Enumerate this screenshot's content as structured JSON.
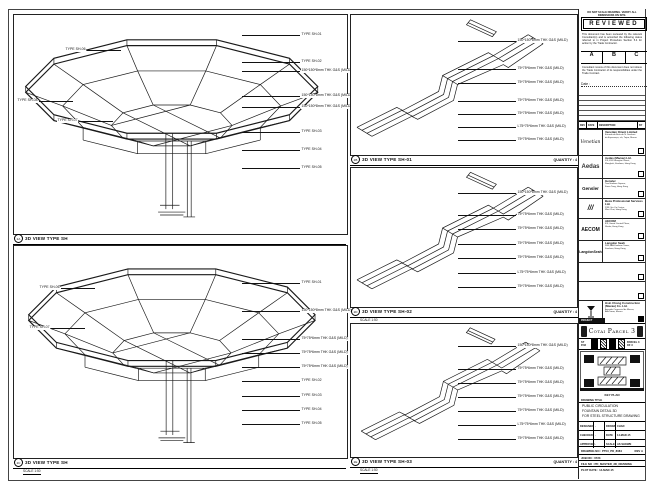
{
  "panels": {
    "left_top": {
      "ref": "2A",
      "title": "3D VIEW TYPE SH",
      "right_labels": [
        "TYPE SH-01",
        "TYPE SH-02",
        "150*150*8mm THK G&S (MILD)",
        "150*150*8mm THK G&S (MILD)",
        "150*150*8mm THK G&S (MILD)",
        "TYPE SH-03",
        "TYPE SH-04",
        "TYPE SH-05"
      ],
      "left_labels": [
        "TYPE SH-06",
        "TYPE SH-07",
        "TYPE SH-08"
      ]
    },
    "left_bottom": {
      "ref": "2C",
      "title": "3D VIEW TYPE SH",
      "scale": "SCALE 1:50",
      "right_labels": [
        "TYPE SH-01",
        "150*150*8mm THK G&S (MILD)",
        "75*75*6mm THK G&S (MILD)",
        "75*75*6mm THK G&S (MILD)",
        "75*75*6mm THK G&S (MILD)",
        "TYPE SH-02",
        "TYPE SH-03",
        "TYPE SH-04",
        "TYPE SH-05"
      ],
      "left_labels": [
        "TYPE SH-06",
        "TYPE SH-07"
      ]
    },
    "mid": [
      {
        "ref": "2B",
        "title": "3D VIEW TYPE SH-01",
        "quantity": "QUANTITY : 4",
        "labels": [
          "150*150*8mm THK G&S (MILD)",
          "75*75*6mm THK G&S (MILD)",
          "75*75*6mm THK G&S (MILD)",
          "75*75*6mm THK G&S (MILD)",
          "75*75*6mm THK G&S (MILD)",
          "L75*75*6mm THK G&S (MILD)",
          "75*75*6mm THK G&S (MILD)"
        ]
      },
      {
        "ref": "2D",
        "title": "3D VIEW TYPE SH-02",
        "quantity": "QUANTITY : 4",
        "scale": "SCALE 1:50",
        "labels": [
          "150*150*8mm THK G&S (MILD)",
          "75*75*6mm THK G&S (MILD)",
          "75*75*6mm THK G&S (MILD)",
          "75*75*6mm THK G&S (MILD)",
          "75*75*6mm THK G&S (MILD)",
          "L75*75*6mm THK G&S (MILD)",
          "75*75*6mm THK G&S (MILD)"
        ]
      },
      {
        "ref": "2E",
        "title": "3D VIEW TYPE SH-03",
        "quantity": "QUANTITY : 4",
        "scale": "SCALE 1:50",
        "labels": [
          "150*150*8mm THK G&S (MILD)",
          "75*75*6mm THK G&S (MILD)",
          "75*75*6mm THK G&S (MILD)",
          "75*75*6mm THK G&S (MILD)",
          "75*75*6mm THK G&S (MILD)",
          "L75*75*6mm THK G&S (MILD)",
          "75*75*6mm THK G&S (MILD)"
        ]
      }
    ]
  },
  "titleblock": {
    "top_note": "DO NOT SCALE DRAWING. VERIFY ALL DIMENSIONS ON SITE.",
    "stamp": {
      "title": "REVIEWED",
      "body1": "This document has been reviewed by the relevant Consultant(s) and is accorded the following status referred to in Project Procedure Section 5.4 for action by the Trade Contractor.",
      "cols": [
        "A",
        "B",
        "C"
      ],
      "body2": "Consultant review of this document does not relieve the Trade Contractor of its responsibilities under the Trade Contract.",
      "date_label": "Date :"
    },
    "rev_headers": [
      "REV",
      "DATE",
      "DESCRIPTION",
      "BY"
    ],
    "consultants": [
      {
        "logo": "Venetian",
        "name": "Venetian Orient Limited",
        "addr1": "Estrada da Baía de N. Senhora",
        "addr2": "da Esperança, s/n, Taipa, Macau"
      },
      {
        "logo": "Aedas",
        "name": "Aedas (Macau) Ltd.",
        "addr1": "5/F, 618 Shanghai Street,",
        "addr2": "Mongkok, Kowloon, Hong Kong"
      },
      {
        "logo": "Gensler",
        "name": "Gensler",
        "addr1": "Two Harbour Square,",
        "addr2": "Kwun Tong, Hong Kong"
      },
      {
        "logo": "///",
        "name": "Beca Professional Services Ltd.",
        "addr1": "23/F, Siu On Centre,",
        "addr2": "Wan Chai, Hong Kong"
      },
      {
        "logo": "AECOM",
        "name": "AECOM",
        "addr1": "8/F, Grand Central Plaza,",
        "addr2": "Shatin, Hong Kong"
      },
      {
        "logo": "LangdonSeah",
        "name": "Langdon Seah",
        "addr1": "38/F, AIA Kowloon Tower,",
        "addr2": "Kowloon, Hong Kong"
      }
    ],
    "contractor": {
      "name": "Hsin Chong Construction (Macau) Co. Ltd.",
      "addr1": "Avenida Comercial de Macau,",
      "addr2": "AIA Tower, Macau",
      "tag": "PROJECT"
    },
    "banner": {
      "project": "Cotai Parcel 3"
    },
    "keyplan": {
      "strip_label": "ST P.03",
      "strip_label2": "PARCEL 3 OF 3",
      "caption": "KEY PLAN"
    },
    "title_section": {
      "label": "DRAWING TITLE",
      "line1": "PUBLIC CIRCULATION",
      "line2": "FOUNTAIN DETAIL 3D",
      "line3": "FOR STEEL STRUCTURE DRAWING"
    },
    "signoff": {
      "rows": [
        {
          "l1": "DESIGNED",
          "v1": "-",
          "l2": "DRAWN",
          "v2": "CHAD"
        },
        {
          "l1": "CHECKED",
          "v1": "-",
          "l2": "DATE",
          "v2": "14-MAR-15"
        },
        {
          "l1": "APPROVED",
          "v1": "-",
          "l2": "SCALE",
          "v2": "AS SHOWN"
        }
      ]
    },
    "numbers": {
      "drawing_no_label": "DRAWING NO :",
      "drawing_no": "PT03_PD_8084",
      "rev": "REV A",
      "job": "JOB NO : 0723",
      "file": "FILE NO : PD_MASTER_3D_DRAWING",
      "plot": "PLOT DATE : 14-MAR-15"
    }
  }
}
